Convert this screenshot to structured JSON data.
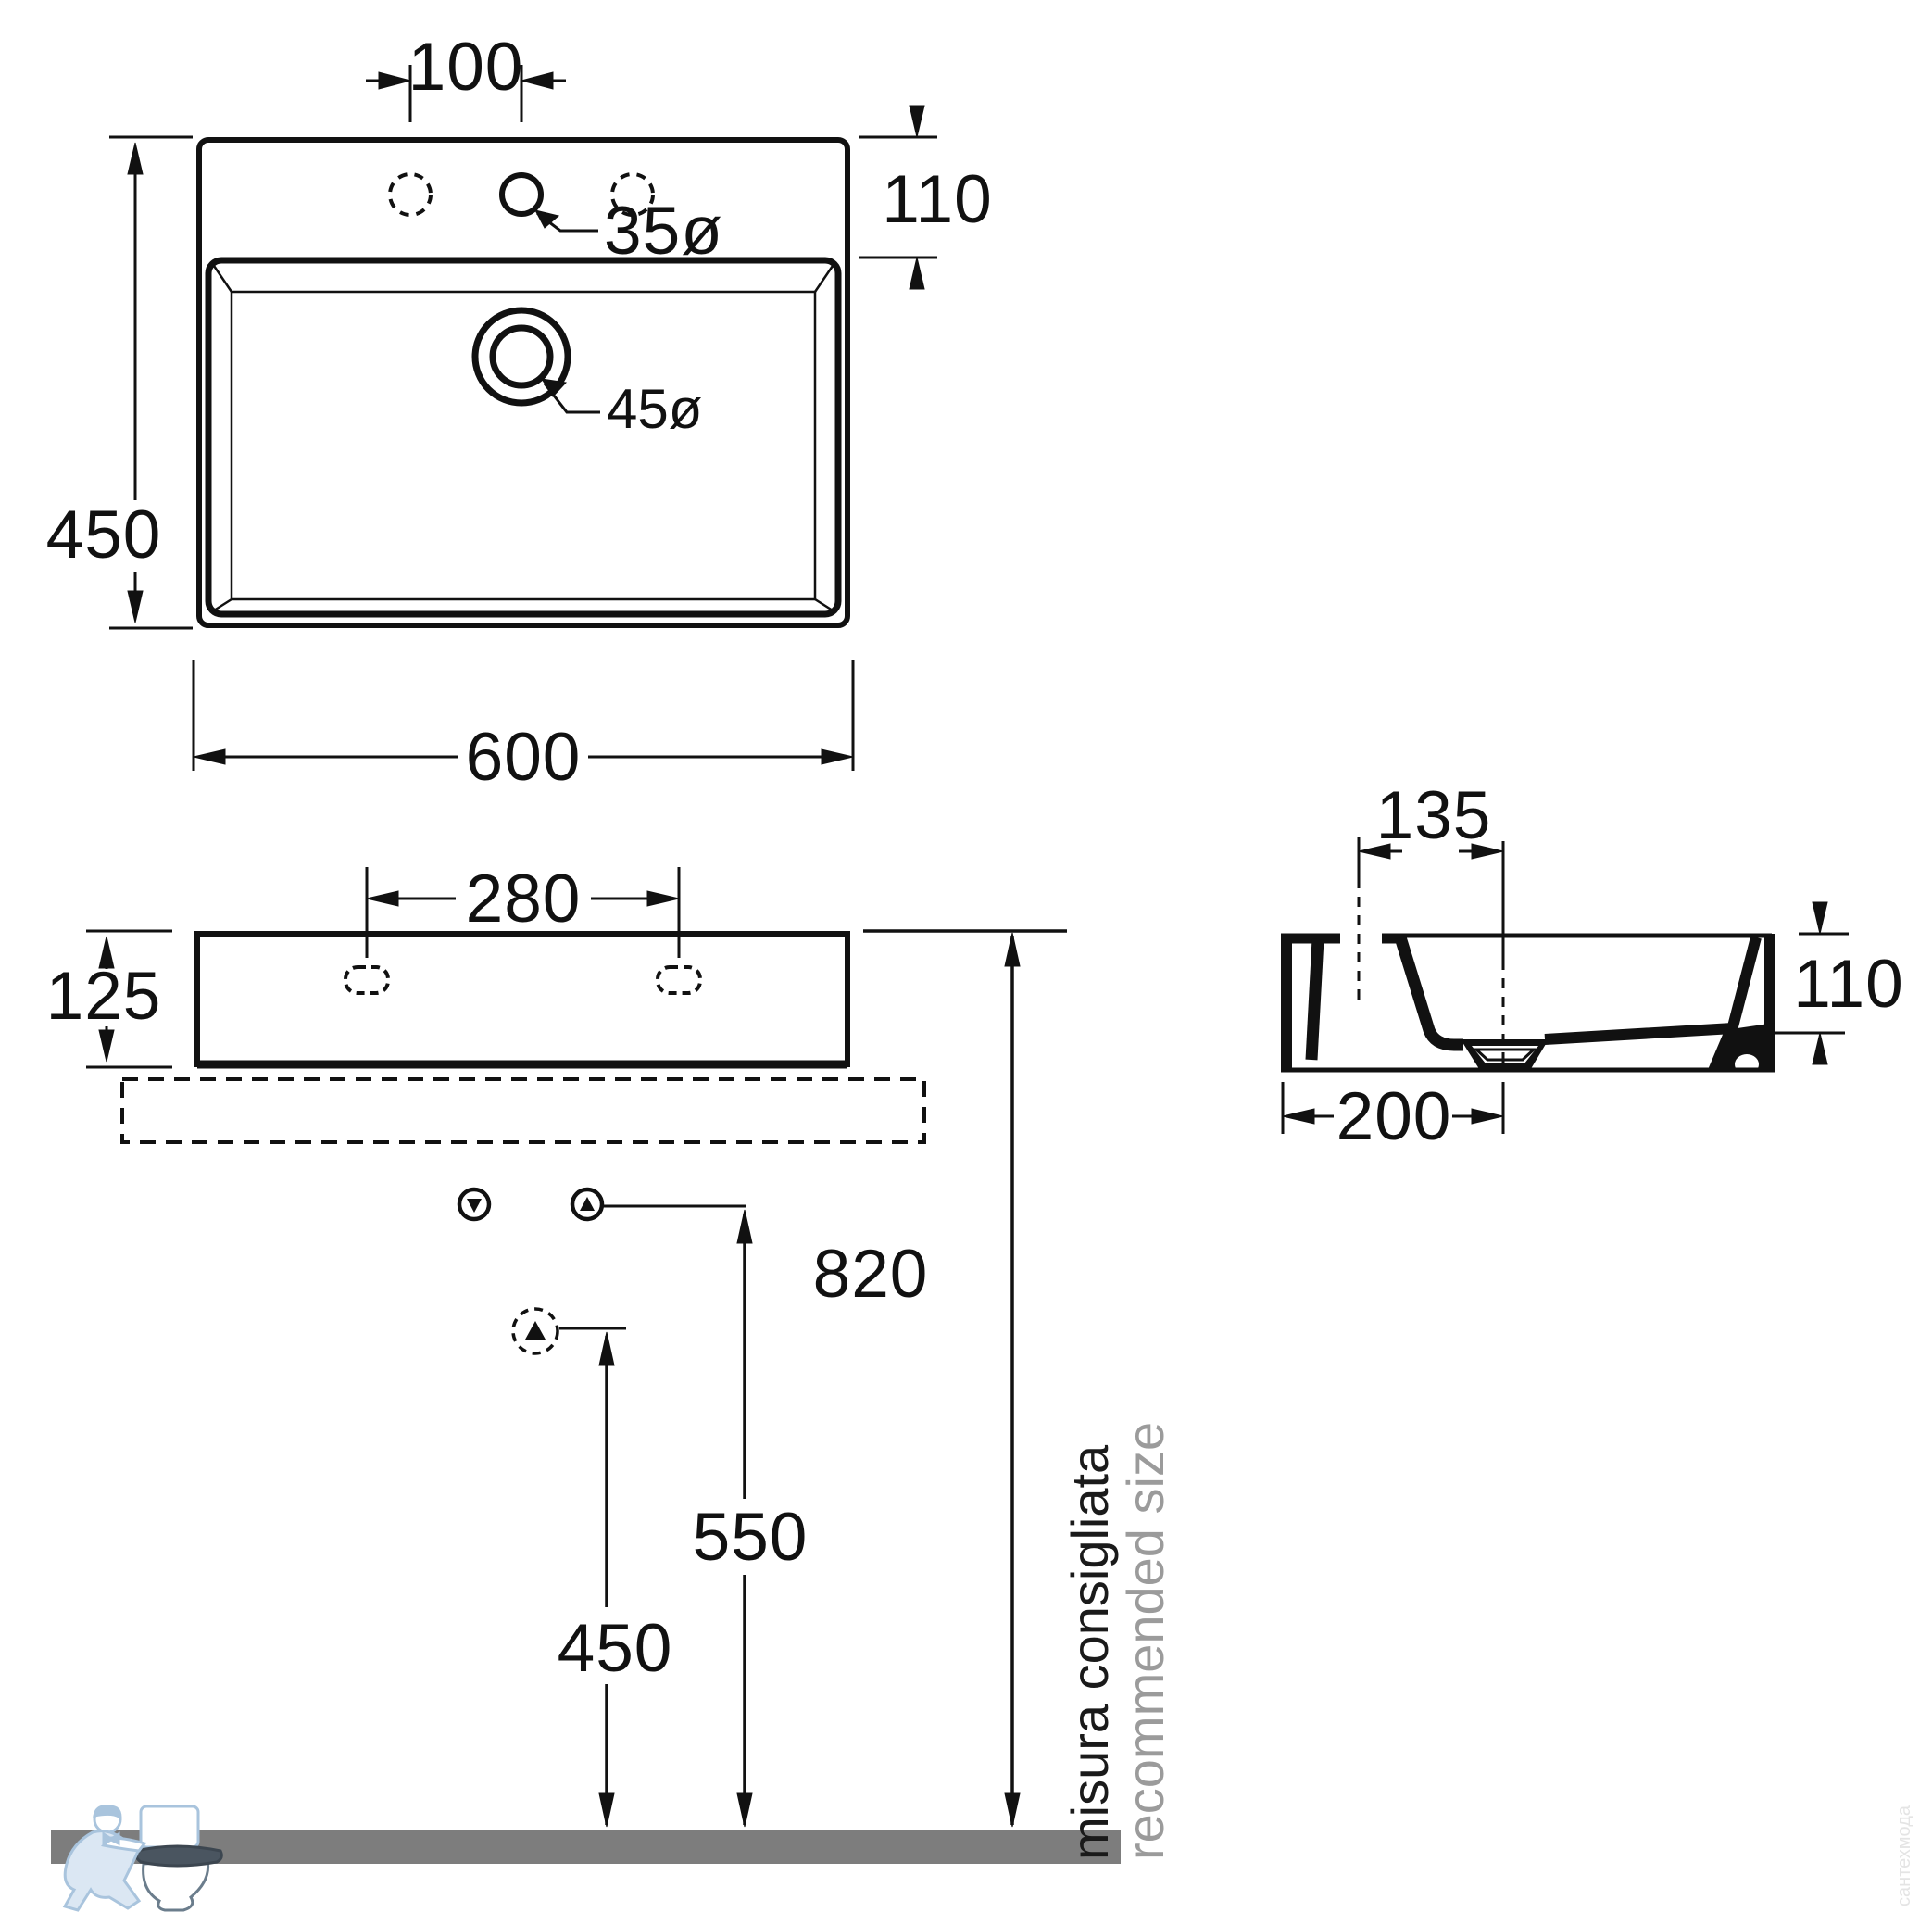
{
  "top_view": {
    "faucet_offset": "100",
    "deck_depth": "110",
    "height": "450",
    "width": "600",
    "faucet_hole_diameter": "35ø",
    "drain_diameter": "45ø"
  },
  "front_view": {
    "faucet_spacing": "280",
    "body_height": "125",
    "rim_height_from_floor": "820",
    "supply_height": "550",
    "outlet_height": "450"
  },
  "side_view": {
    "drain_offset": "135",
    "basin_depth": "110",
    "drain_distance": "200"
  },
  "notes": {
    "italian": "misura consigliata",
    "english": "recommended size"
  },
  "watermark": {
    "side_text": "сантехмода"
  },
  "colors": {
    "line": "#111111",
    "floor_gray": "#7d7d7d",
    "note_gray": "#9b9b9b",
    "logo_blue": "#a9c4dd"
  }
}
